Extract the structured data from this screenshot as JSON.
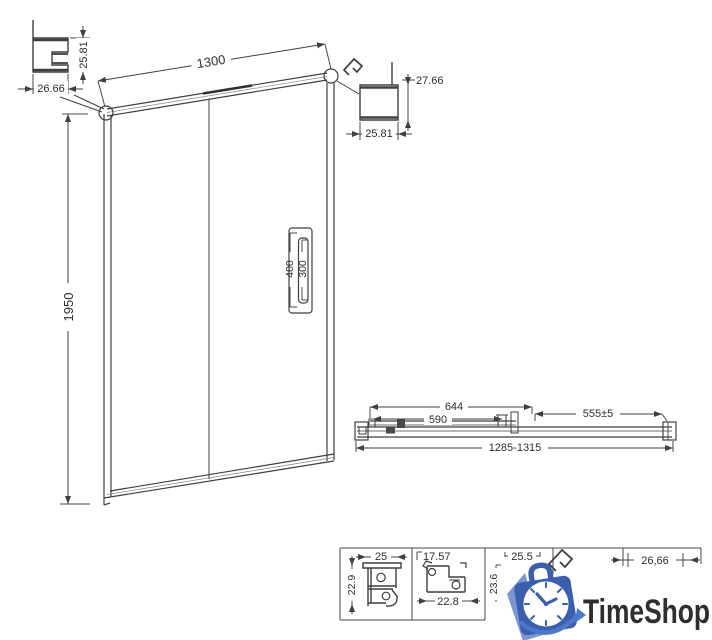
{
  "dims": {
    "tl_width": "26.66",
    "tl_height": "25.81",
    "door_width": "1300",
    "door_height": "1950",
    "handle_outer": "400",
    "handle_inner": "300",
    "tr_height": "27.66",
    "tr_width": "25.81",
    "plan_644": "644",
    "plan_590": "590",
    "plan_555": "555±5",
    "plan_overall": "1285-1315",
    "p1_width": "25",
    "p1_height": "22.9",
    "p2_width": "17.57",
    "p2_bottom": "22.8",
    "p3_width": "25.5",
    "p3_height": "23.6",
    "p5_width": "26,66"
  },
  "logo": {
    "text": "TimeShop",
    "text_color": "#4a74c8",
    "dark_blue": "#3b5fad",
    "light_blue": "#7c96d4"
  },
  "drawing": {
    "line_color": "#3f3f3f",
    "dim_color": "#4a4a4a"
  }
}
